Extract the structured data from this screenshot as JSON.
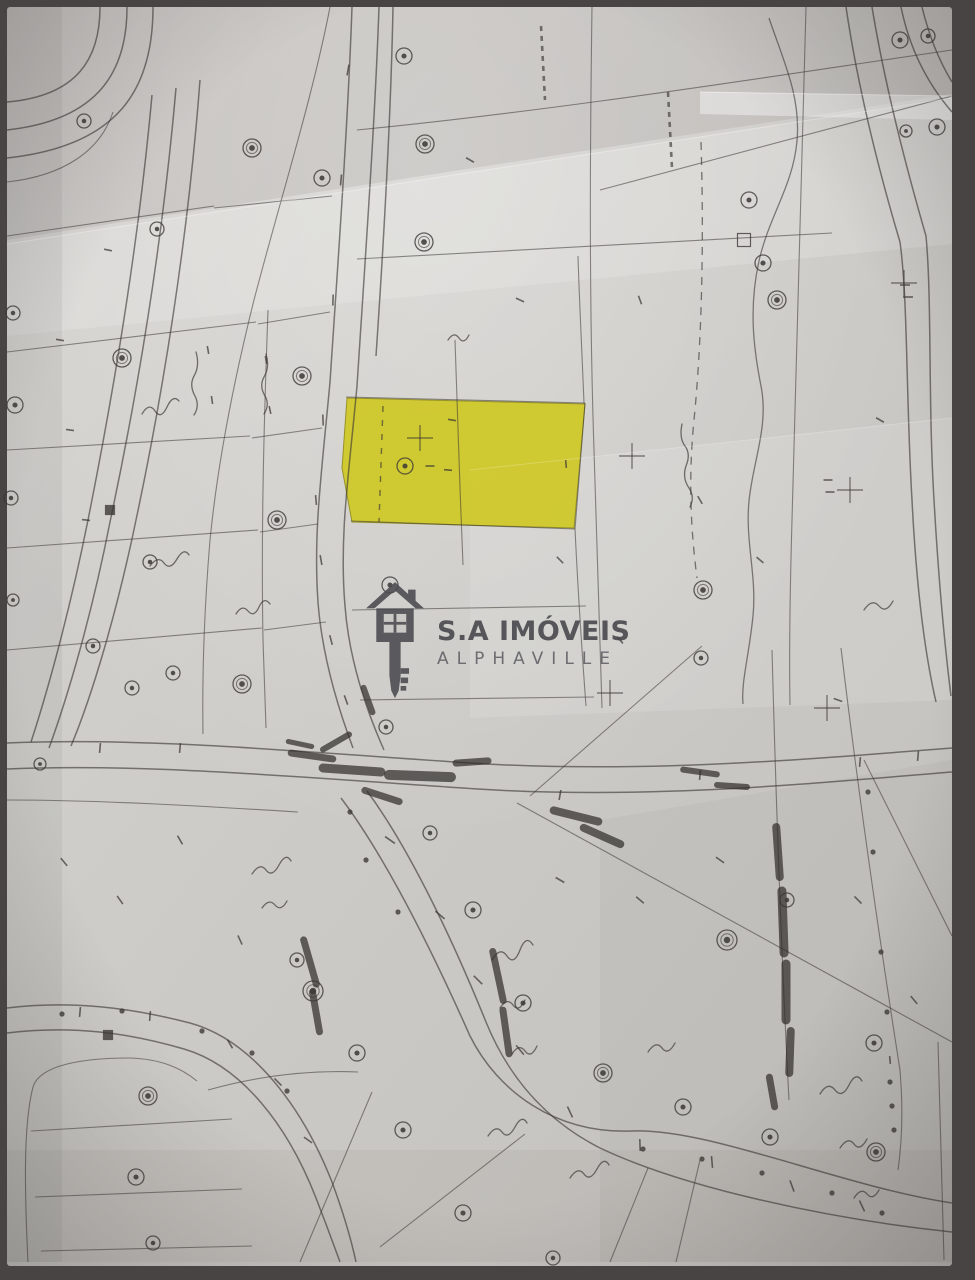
{
  "photo": {
    "frame_color": "#474443",
    "paper_color_light": "#d7d5d1",
    "paper_color_dark": "#c2c0bc"
  },
  "watermark": {
    "title": "S.A IMÓVEIS",
    "subtitle": "ALPHAVILLE",
    "icon": "house-key-icon",
    "color": "#4a4a4f"
  },
  "highlight": {
    "label": "highlighted-lot",
    "fill": "#cfc81d",
    "stroke": "#8f8a10",
    "opacity": 0.88,
    "points": "347,398 585,404 574,528 352,522 342,468"
  },
  "map": {
    "ink": "#3a3734",
    "smudge_ink": "#2e2b29",
    "roads": [
      "M 100,7 C 100,58 78,96 7,102",
      "M 127,7 C 127,72 98,120 7,130",
      "M 153,7 C 153,90 118,146 7,158",
      "M 152,95 C 138,250 112,400 88,520 C 70,610 48,690 31,742",
      "M 176,88 C 162,248 136,400 110,522 C 92,614 68,696 49,748",
      "M 200,80 C 188,240 162,398 136,520 C 117,612 92,696 71,746",
      "M 352,7 C 348,122 338,262 330,382 C 322,470 313,532 318,602 C 322,656 338,708 353,748",
      "M 379,7 C 375,122 365,262 357,386 C 349,474 339,536 345,606 C 349,660 367,712 384,750",
      "M 393,7 C 391,110 384,238 376,356",
      "M 7,743 C 150,737 300,752 470,763 C 640,774 812,759 952,748",
      "M 7,769 C 150,763 308,778 478,789 C 648,800 816,783 952,772",
      "M 341,798 C 384,855 430,946 470,1036 C 498,1092 556,1134 632,1131 C 710,1128 840,1186 952,1203",
      "M 367,791 C 409,848 452,938 486,1022 C 508,1076 545,1120 600,1148 C 680,1186 820,1218 952,1232",
      "M 7,1008 C 72,1000 132,1008 190,1023 C 252,1040 302,1106 332,1182 C 346,1220 353,1248 356,1262",
      "M 7,1033 C 72,1025 130,1033 184,1049 C 242,1066 288,1126 316,1198 C 330,1234 337,1254 340,1262",
      "M 846,7 C 858,88 878,168 900,242 C 908,300 906,400 912,500 C 916,580 924,650 936,702",
      "M 872,7 C 884,80 904,160 926,236 C 932,300 928,400 934,500 C 938,570 944,640 951,696",
      "M 901,7 C 909,46 926,82 952,112",
      "M 922,7 C 930,40 941,64 952,82"
    ],
    "lines": [
      "M 7,236 L 214,206",
      "M 7,352 L 256,322",
      "M 7,450 L 250,436",
      "M 7,548 L 258,530",
      "M 7,650 L 262,628",
      "M 214,208 L 332,196",
      "M 258,324 L 330,312",
      "M 252,438 L 322,428",
      "M 260,532 L 318,524",
      "M 264,630 L 326,622",
      "M 330,7 C 312,100 280,200 254,300 C 234,380 218,460 210,540 C 204,612 202,672 203,734",
      "M 268,310 C 264,420 261,530 263,640 L 266,728",
      "M 357,130 C 560,110 760,78 952,50",
      "M 357,259 L 832,233",
      "M 600,190 L 952,96",
      "M 592,7 C 590,150 589,300 594,450 C 597,550 600,640 602,708",
      "M 806,7 C 802,150 797,340 792,520 C 790,590 789,650 790,705",
      "M 455,340 C 457,410 460,490 463,565",
      "M 346,397 L 585,403",
      "M 351,521 L 575,529",
      "M 585,403 L 575,529",
      "M 575,529 C 578,592 582,652 586,706",
      "M 584,403 C 581,330 579,292 578,256",
      "M 352,610 L 586,606",
      "M 360,700 L 594,697",
      "M 517,803 L 952,1042",
      "M 530,796 L 702,646",
      "M 772,650 C 776,800 781,950 789,1100",
      "M 841,648 C 858,790 878,930 900,1070 C 903,1106 902,1142 898,1170",
      "M 938,1042 C 940,1120 942,1190 944,1260",
      "M 864,760 L 952,936",
      "M 28,1262 C 24,1180 24,1122 33,1087 C 40,1064 86,1058 130,1058 C 161,1059 181,1068 197,1081",
      "M 31,1131 L 232,1119",
      "M 35,1197 L 242,1189",
      "M 41,1251 L 252,1246",
      "M 300,1262 L 372,1092",
      "M 380,1247 L 525,1134",
      "M 610,1262 L 648,1168",
      "M 676,1262 L 700,1160",
      "M 7,182 C 62,176 100,152 113,112",
      "M 7,800 C 100,800 200,806 298,812",
      "M 208,1090 C 258,1076 310,1070 358,1072"
    ],
    "dashed": [
      {
        "d": "M 701,142 C 704,240 702,340 694,420 C 688,480 691,532 697,578",
        "da": "8 7",
        "w": 1.3
      },
      {
        "d": "M 668,92 L 672,168",
        "da": "5 5",
        "w": 2.6
      },
      {
        "d": "M 541,26 L 545,100",
        "da": "5 5",
        "w": 2.6
      },
      {
        "d": "M 383,406 L 379,522",
        "da": "6 8",
        "w": 1.4
      }
    ],
    "creek": "M 769,18 C 783,60 801,96 797,141 C 793,186 769,216 759,261 C 749,306 753,346 761,386 C 769,426 753,461 749,501 C 745,541 757,576 753,616 C 749,656 741,682 743,704",
    "markers": [
      [
        84,
        121,
        7
      ],
      [
        252,
        148,
        9
      ],
      [
        322,
        178,
        8
      ],
      [
        157,
        229,
        7
      ],
      [
        122,
        358,
        9
      ],
      [
        13,
        313,
        7
      ],
      [
        15,
        405,
        8
      ],
      [
        11,
        498,
        7
      ],
      [
        302,
        376,
        9
      ],
      [
        277,
        520,
        9
      ],
      [
        150,
        562,
        7
      ],
      [
        93,
        646,
        7
      ],
      [
        13,
        600,
        6
      ],
      [
        173,
        673,
        7
      ],
      [
        132,
        688,
        7
      ],
      [
        242,
        684,
        9
      ],
      [
        40,
        764,
        6
      ],
      [
        404,
        56,
        8
      ],
      [
        425,
        144,
        9
      ],
      [
        424,
        242,
        9
      ],
      [
        405,
        466,
        8
      ],
      [
        390,
        585,
        8
      ],
      [
        386,
        727,
        7
      ],
      [
        430,
        833,
        7
      ],
      [
        749,
        200,
        8
      ],
      [
        763,
        263,
        8
      ],
      [
        777,
        300,
        9
      ],
      [
        703,
        590,
        9
      ],
      [
        701,
        658,
        7
      ],
      [
        900,
        40,
        8
      ],
      [
        928,
        36,
        7
      ],
      [
        937,
        127,
        8
      ],
      [
        906,
        131,
        6
      ],
      [
        297,
        960,
        7
      ],
      [
        313,
        991,
        10
      ],
      [
        357,
        1053,
        8
      ],
      [
        403,
        1130,
        8
      ],
      [
        473,
        910,
        8
      ],
      [
        523,
        1003,
        8
      ],
      [
        603,
        1073,
        9
      ],
      [
        463,
        1213,
        8
      ],
      [
        683,
        1107,
        8
      ],
      [
        553,
        1258,
        7
      ],
      [
        727,
        940,
        10
      ],
      [
        787,
        900,
        7
      ],
      [
        874,
        1043,
        8
      ],
      [
        876,
        1152,
        9
      ],
      [
        770,
        1137,
        8
      ],
      [
        148,
        1096,
        9
      ],
      [
        136,
        1177,
        8
      ],
      [
        153,
        1243,
        7
      ]
    ],
    "dots": [
      [
        62,
        1014
      ],
      [
        122,
        1011
      ],
      [
        202,
        1031
      ],
      [
        252,
        1053
      ],
      [
        287,
        1091
      ],
      [
        643,
        1149
      ],
      [
        702,
        1159
      ],
      [
        762,
        1173
      ],
      [
        832,
        1193
      ],
      [
        882,
        1213
      ],
      [
        868,
        792
      ],
      [
        873,
        852
      ],
      [
        881,
        952
      ],
      [
        887,
        1012
      ],
      [
        350,
        812
      ],
      [
        366,
        860
      ],
      [
        398,
        912
      ],
      [
        890,
        1082
      ],
      [
        892,
        1106
      ],
      [
        894,
        1130
      ]
    ],
    "ticks": [
      [
        348,
        70,
        11,
        100
      ],
      [
        341,
        180,
        11,
        95
      ],
      [
        333,
        300,
        11,
        92
      ],
      [
        323,
        420,
        11,
        88
      ],
      [
        316,
        500,
        10,
        85
      ],
      [
        321,
        560,
        10,
        80
      ],
      [
        331,
        640,
        10,
        75
      ],
      [
        346,
        700,
        10,
        70
      ],
      [
        390,
        840,
        12,
        35
      ],
      [
        440,
        915,
        12,
        40
      ],
      [
        478,
        980,
        12,
        45
      ],
      [
        520,
        1050,
        12,
        50
      ],
      [
        570,
        1112,
        12,
        65
      ],
      [
        640,
        1145,
        12,
        88
      ],
      [
        712,
        1162,
        12,
        85
      ],
      [
        792,
        1186,
        12,
        70
      ],
      [
        862,
        1206,
        12,
        65
      ],
      [
        100,
        748,
        10,
        95
      ],
      [
        180,
        748,
        10,
        95
      ],
      [
        560,
        795,
        10,
        100
      ],
      [
        700,
        775,
        10,
        95
      ],
      [
        860,
        762,
        10,
        95
      ],
      [
        918,
        756,
        10,
        95
      ],
      [
        80,
        1012,
        10,
        95
      ],
      [
        150,
        1016,
        10,
        95
      ],
      [
        230,
        1044,
        10,
        60
      ],
      [
        278,
        1082,
        10,
        45
      ],
      [
        308,
        1140,
        10,
        35
      ],
      [
        470,
        160,
        9,
        30
      ],
      [
        520,
        300,
        9,
        25
      ],
      [
        640,
        300,
        9,
        70
      ],
      [
        700,
        500,
        9,
        60
      ],
      [
        560,
        560,
        9,
        45
      ],
      [
        620,
        640,
        9,
        50
      ],
      [
        760,
        560,
        9,
        40
      ],
      [
        880,
        420,
        9,
        30
      ],
      [
        838,
        700,
        9,
        20
      ],
      [
        640,
        900,
        10,
        40
      ],
      [
        720,
        860,
        10,
        35
      ],
      [
        560,
        880,
        10,
        30
      ],
      [
        858,
        900,
        10,
        45
      ],
      [
        914,
        1000,
        10,
        50
      ],
      [
        180,
        840,
        10,
        60
      ],
      [
        120,
        900,
        10,
        55
      ],
      [
        64,
        862,
        10,
        50
      ],
      [
        240,
        940,
        10,
        65
      ],
      [
        452,
        420,
        8,
        10
      ],
      [
        448,
        470,
        8,
        5
      ],
      [
        430,
        466,
        9,
        0
      ],
      [
        566,
        464,
        8,
        85
      ],
      [
        828,
        480,
        9,
        0
      ],
      [
        830,
        492,
        9,
        0
      ],
      [
        208,
        350,
        8,
        80
      ],
      [
        212,
        400,
        8,
        82
      ],
      [
        266,
        360,
        8,
        80
      ],
      [
        270,
        410,
        8,
        78
      ],
      [
        108,
        250,
        8,
        12
      ],
      [
        60,
        340,
        8,
        10
      ],
      [
        70,
        430,
        8,
        8
      ],
      [
        86,
        520,
        8,
        6
      ],
      [
        905,
        285,
        10,
        0
      ],
      [
        908,
        297,
        10,
        0
      ],
      [
        890,
        1060,
        8,
        85
      ]
    ],
    "smudges": [
      [
        312,
        756,
        42,
        8,
        7
      ],
      [
        352,
        770,
        58,
        4,
        9
      ],
      [
        420,
        776,
        62,
        2,
        10
      ],
      [
        472,
        762,
        32,
        -4,
        7
      ],
      [
        382,
        796,
        36,
        18,
        7
      ],
      [
        336,
        742,
        30,
        -30,
        6
      ],
      [
        300,
        744,
        24,
        12,
        5
      ],
      [
        576,
        816,
        46,
        14,
        8
      ],
      [
        602,
        836,
        40,
        24,
        8
      ],
      [
        778,
        852,
        50,
        86,
        8
      ],
      [
        783,
        922,
        62,
        88,
        9
      ],
      [
        786,
        992,
        56,
        90,
        9
      ],
      [
        790,
        1052,
        42,
        92,
        8
      ],
      [
        772,
        1092,
        30,
        80,
        7
      ],
      [
        310,
        962,
        46,
        74,
        7
      ],
      [
        316,
        1012,
        40,
        80,
        7
      ],
      [
        498,
        976,
        50,
        78,
        7
      ],
      [
        506,
        1032,
        44,
        82,
        7
      ],
      [
        700,
        772,
        34,
        8,
        6
      ],
      [
        732,
        786,
        30,
        4,
        6
      ],
      [
        368,
        700,
        26,
        70,
        6
      ]
    ],
    "scribbles": [
      "M 142,414 q 7,-12 13,-3 t 12,-4 t 12,-6",
      "M 196,352 q 4,14 -2,24 q -5,9 1,20 q 5,10 -1,19",
      "M 266,354 q 4,13 -2,23 q -5,9 1,19 q 5,9 -1,18",
      "M 150,566 q 8,-11 14,-3 t 13,-4 t 12,-4",
      "M 236,614 q 6,-10 12,-3 t 11,-4 t 11,-3",
      "M 252,874 q 8,-12 14,-4 t 13,-5 t 12,-4",
      "M 262,908 q 7,-10 13,-3 t 12,-4",
      "M 492,960 q 8,-14 15,-4 t 13,-6 t 13,-5",
      "M 500,1008 q 7,-11 13,-3 t 12,-5",
      "M 512,1054 q 7,-11 13,-3 t 12,-5",
      "M 488,1136 q 8,-12 14,-4 t 13,-5 t 12,-4",
      "M 570,1178 q 8,-12 14,-4 t 13,-5 t 12,-4",
      "M 648,1052 q 8,-12 14,-4 t 13,-5",
      "M 820,1094 q 8,-13 15,-4 t 14,-5 t 13,-4",
      "M 840,1148 q 8,-12 14,-4 t 13,-5",
      "M 854,1198 q 7,-11 13,-4 t 12,-4",
      "M 864,610 q 8,-12 15,-4 t 14,-5",
      "M 682,424 q -3,14 3,22 q 6,8 1,20 q -4,12 3,22 q 6,9 1,19",
      "M 448,340 q 6,-9 11,-2 t 10,-3"
    ],
    "crosses": [
      [
        420,
        438
      ],
      [
        632,
        456
      ],
      [
        850,
        490
      ],
      [
        610,
        693
      ],
      [
        827,
        708
      ],
      [
        904,
        283
      ]
    ],
    "squares": [
      [
        110,
        510,
        9,
        1
      ],
      [
        108,
        1035,
        9,
        1
      ],
      [
        744,
        240,
        13,
        0
      ]
    ],
    "shades": [
      {
        "d": "M 7,244 L 952,98 L 952,244 L 7,336 Z",
        "f": "#ffffff",
        "o": 0.16
      },
      {
        "d": "M 470,470 L 952,418 L 952,700 L 470,718 Z",
        "f": "#ffffff",
        "o": 0.12
      },
      {
        "d": "M 7,7 L 952,7 L 952,94 L 7,240 Z",
        "f": "#76736f",
        "o": 0.14
      },
      {
        "d": "M 600,820 L 952,760 L 952,1262 L 600,1262 Z",
        "f": "#76736f",
        "o": 0.07
      },
      {
        "d": "M 7,1150 L 952,1150 L 952,1262 L 7,1262 Z",
        "f": "#6f6c68",
        "o": 0.08
      },
      {
        "d": "M 7,7 L 62,7 L 62,1262 L 7,1262 Z",
        "f": "#6f6c68",
        "o": 0.1
      },
      {
        "d": "M 700,92 L 952,96 L 952,120 L 700,114 Z",
        "f": "#ffffff",
        "o": 0.4
      }
    ],
    "creases": [
      {
        "d": "M 7,244 L 952,98",
        "o": 0.35
      },
      {
        "d": "M 470,470 L 952,418",
        "o": 0.22
      },
      {
        "d": "M 700,92 L 952,96",
        "o": 0.5
      }
    ]
  }
}
